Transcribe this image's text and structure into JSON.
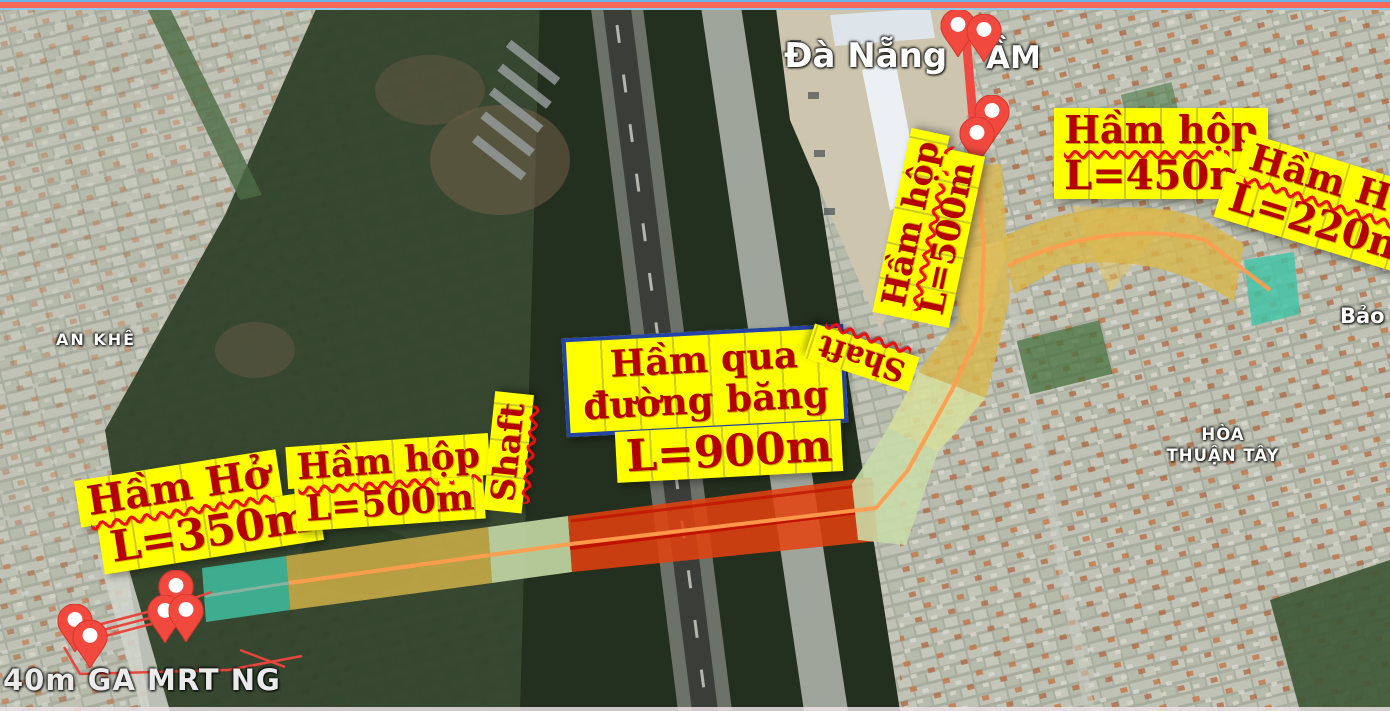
{
  "map_labels": {
    "city": "Đà Nẵng",
    "partial_am": "ẦM",
    "an_khe": "AN KHÊ",
    "hoa": "HÒA",
    "thuan_tay": "THUẬN TÂY",
    "bao": "Bảo",
    "station": "40m GA MRT NG"
  },
  "annotations": {
    "ham_ho_350": {
      "line1": "Hầm Hở",
      "line2": "L=350m"
    },
    "ham_hop_500_west": {
      "line1": "Hầm hộp",
      "line2": "L=500m"
    },
    "shaft_west": {
      "label": "Shaft"
    },
    "ham_qua_duong_bang": {
      "line1": "Hầm qua",
      "line2": "đường băng"
    },
    "l_900": {
      "label": "L=900m"
    },
    "shaft_east": {
      "label": "Shaft"
    },
    "ham_hop_500_north": {
      "line1": "Hầm hộp",
      "line2": "L=500m"
    },
    "ham_hop_450": {
      "line1": "Hầm hộp",
      "line2": "L=450m"
    },
    "ham_ho_220": {
      "line1": "Hầm Hở",
      "line2": "L=220m"
    }
  },
  "icons": {
    "pin": "map-pin"
  },
  "colors": {
    "label_bg": "#FFFF00",
    "label_text": "#B50000",
    "label_border_blue": "#2343A6",
    "segment_cut_and_cover": "#D8B64A",
    "segment_open_tunnel": "#3FC3A5",
    "segment_runway_tunnel": "#E5410E",
    "segment_shaft_zone": "#C8DCA8",
    "route_centerline": "#FF9D4E",
    "pin_red": "#F2493F",
    "top_stripe_red": "#FB695C",
    "top_stripe_blue": "#6AB2E4"
  }
}
